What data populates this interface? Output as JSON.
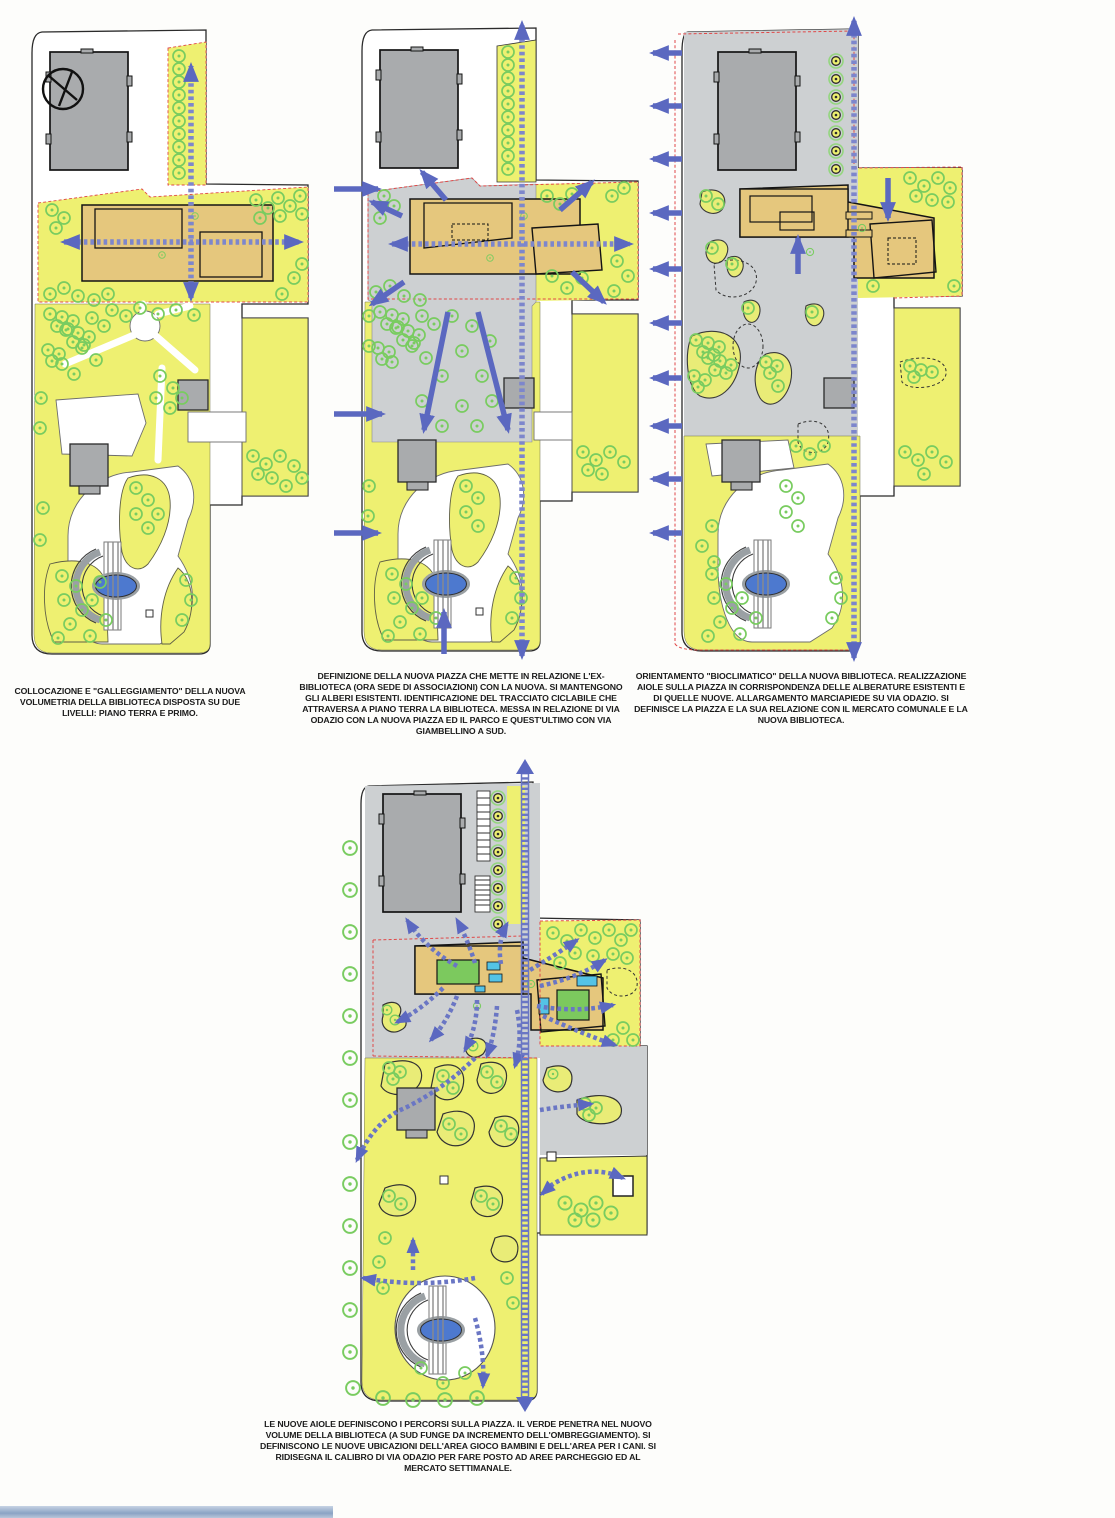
{
  "document": {
    "kind": "urban design concept diagrams",
    "language": "it",
    "panel_count": 4
  },
  "panels": [
    {
      "id": "panel-1",
      "name": "collocazione-volumetria",
      "caption": "COLLOCAZIONE E \"GALLEGGIAMENTO\" DELLA NUOVA VOLUMETRIA DELLA BIBLIOTECA DISPOSTA SU DUE LIVELLI: PIANO TERRA E PRIMO."
    },
    {
      "id": "panel-2",
      "name": "definizione-nuova-piazza",
      "caption": "DEFINIZIONE DELLA NUOVA PIAZZA CHE METTE IN RELAZIONE L'EX-BIBLIOTECA (ORA SEDE DI ASSOCIAZIONI) CON LA NUOVA. SI MANTENGONO GLI ALBERI ESISTENTI. IDENTIFICAZIONE DEL TRACCIATO CICLABILE CHE ATTRAVERSA A PIANO TERRA LA BIBLIOTECA. MESSA IN RELAZIONE DI VIA ODAZIO CON LA NUOVA PIAZZA ED IL PARCO E QUEST'ULTIMO CON VIA GIAMBELLINO A SUD."
    },
    {
      "id": "panel-3",
      "name": "orientamento-bioclimatico",
      "caption": "ORIENTAMENTO \"BIOCLIMATICO\" DELLA NUOVA BIBLIOTECA. REALIZZAZIONE AIOLE SULLA PIAZZA IN CORRISPONDENZA DELLE ALBERATURE ESISTENTI E DI QUELLE NUOVE. ALLARGAMENTO MARCIAPIEDE SU VIA ODAZIO. SI DEFINISCE LA PIAZZA E LA SUA RELAZIONE CON IL MERCATO COMUNALE E LA NUOVA BIBLIOTECA."
    },
    {
      "id": "panel-4",
      "name": "nuove-aiole-percorsi",
      "caption": "LE NUOVE AIOLE DEFINISCONO I PERCORSI SULLA PIAZZA. IL VERDE PENETRA NEL NUOVO VOLUME DELLA BIBLIOTECA (A SUD FUNGE DA INCREMENTO DELL'OMBREGGIAMENTO). SI DEFINISCONO LE NUOVE UBICAZIONI DELL'AREA GIOCO BAMBINI E DELL'AREA PER I CANI. SI RIDISEGNA IL CALIBRO DI VIA ODAZIO PER FARE POSTO AD AREE PARCHEGGIO ED AL MERCATO SETTIMANALE."
    }
  ],
  "map_symbols": {
    "tree-icon": {
      "shape": "circle-with-center-dot",
      "stroke": "#79cc60"
    },
    "formal-tree-icon": {
      "shape": "double-ring-with-dot",
      "stroke": "#2c2c2c",
      "halo": "#93d67e"
    },
    "flow-arrow": {
      "color": "#5b68c0",
      "style": "solid"
    },
    "axis-arrow": {
      "color": "#7d86cc",
      "style": "thick-dashed"
    },
    "cycle-route": {
      "color": "#6a76c4",
      "style": "dashed-ladder"
    },
    "pond": {
      "fill": "#4d79cf"
    },
    "market-building": {
      "fill": "#a9abad"
    },
    "library-building": {
      "fill": "#e5c77d"
    },
    "piazza-surface": {
      "fill": "#cdd0d2"
    },
    "green-area": {
      "fill": "#eef071"
    },
    "site-boundary": {
      "color": "#e04848",
      "style": "red-dashed"
    }
  }
}
